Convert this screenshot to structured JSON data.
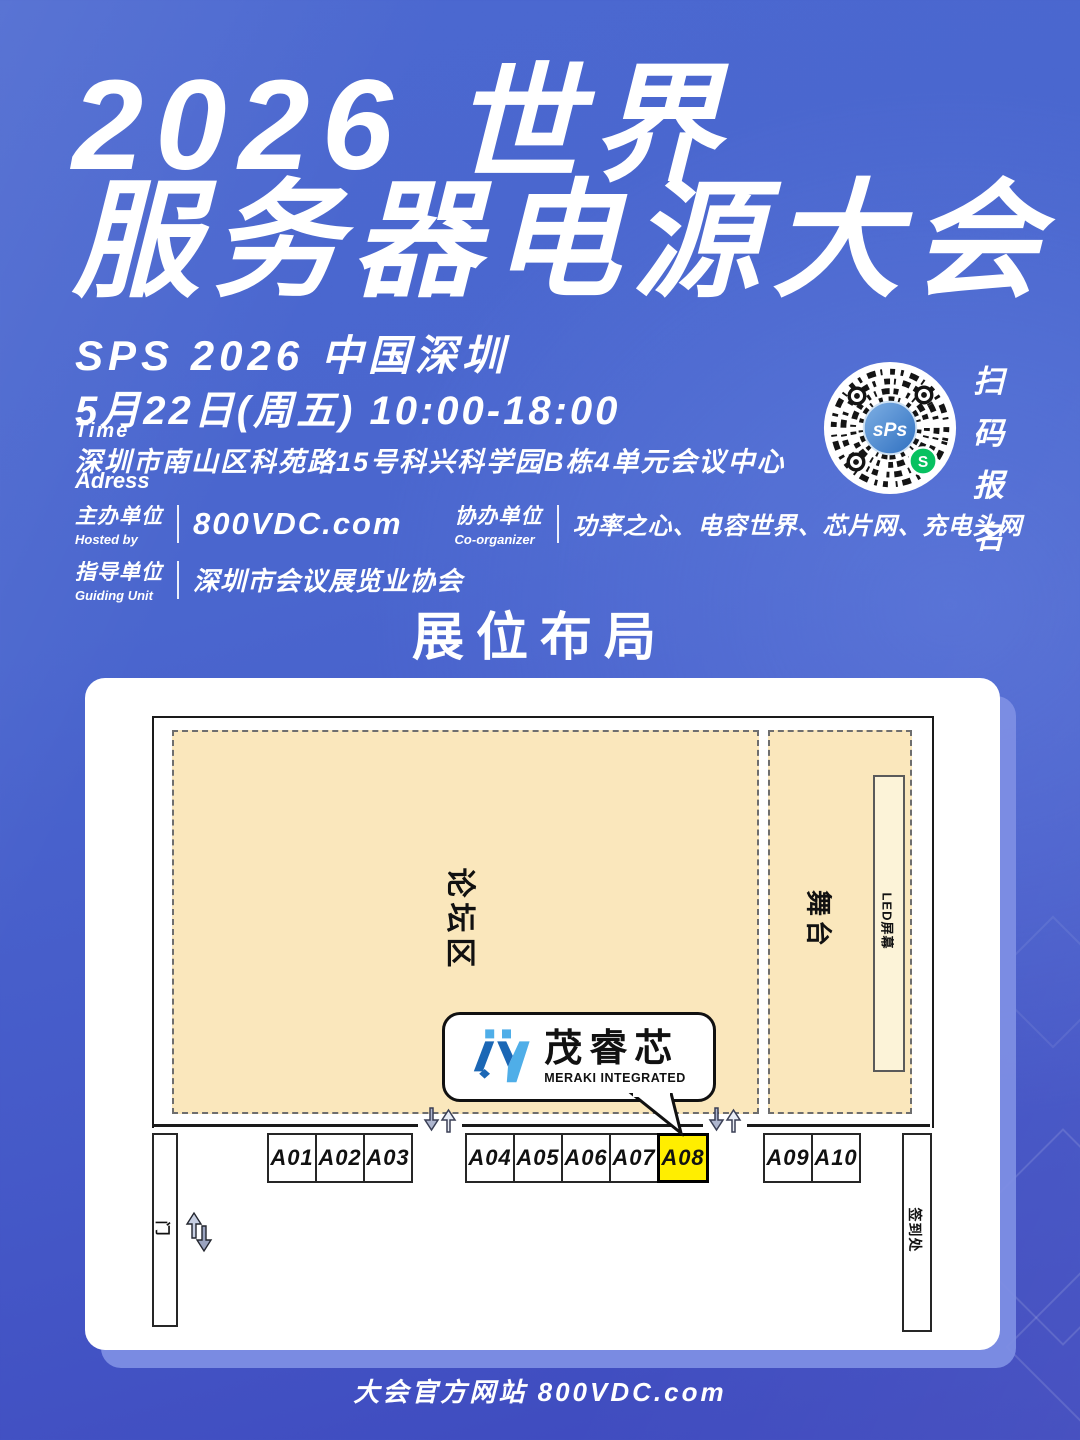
{
  "header": {
    "title_line1": "2026 世界",
    "title_line2": "服务器电源大会",
    "subtitle": "SPS 2026 中国深圳",
    "time_value": "5月22日(周五) 10:00-18:00",
    "time_label": "Time",
    "address_value": "深圳市南山区科苑路15号科兴科学园B栋4单元会议中心",
    "address_label": "Adress"
  },
  "organizers": {
    "hosted_cn": "主办单位",
    "hosted_en": "Hosted by",
    "hosted_value": "800VDC.com",
    "coorg_cn": "协办单位",
    "coorg_en": "Co-organizer",
    "coorg_value": "功率之心、电容世界、芯片网、充电头网",
    "guiding_cn": "指导单位",
    "guiding_en": "Guiding Unit",
    "guiding_value": "深圳市会议展览业协会"
  },
  "qr": {
    "center_text": "sPs",
    "wechat_glyph": "S",
    "caption": [
      "扫",
      "码",
      "报",
      "名"
    ]
  },
  "section": {
    "title_cn": "展位布局",
    "title_en": "Booth Layout"
  },
  "floorplan": {
    "forum_label": "论坛区",
    "stage_label": "舞台",
    "led_label": "LED屏幕",
    "door_label": "门",
    "checkin_label": "签到处",
    "booths": {
      "group1": [
        "A01",
        "A02",
        "A03"
      ],
      "group2": [
        "A04",
        "A05",
        "A06",
        "A07",
        "A08"
      ],
      "group3": [
        "A09",
        "A10"
      ]
    },
    "highlighted_booth": "A08",
    "highlight_color": "#FFEE00",
    "area_fill": "#FAE7BC",
    "callout": {
      "brand_cn": "茂睿芯",
      "brand_en": "MERAKI INTEGRATED"
    }
  },
  "colors": {
    "background_top": "#4A66CE",
    "background_bottom": "#3E48BD",
    "panel_shadow": "#7D8EE4",
    "logo_dark": "#1B67B5",
    "logo_light": "#4FAEE8",
    "wechat_green": "#07C160"
  },
  "footer": {
    "text": "大会官方网站 800VDC.com"
  }
}
